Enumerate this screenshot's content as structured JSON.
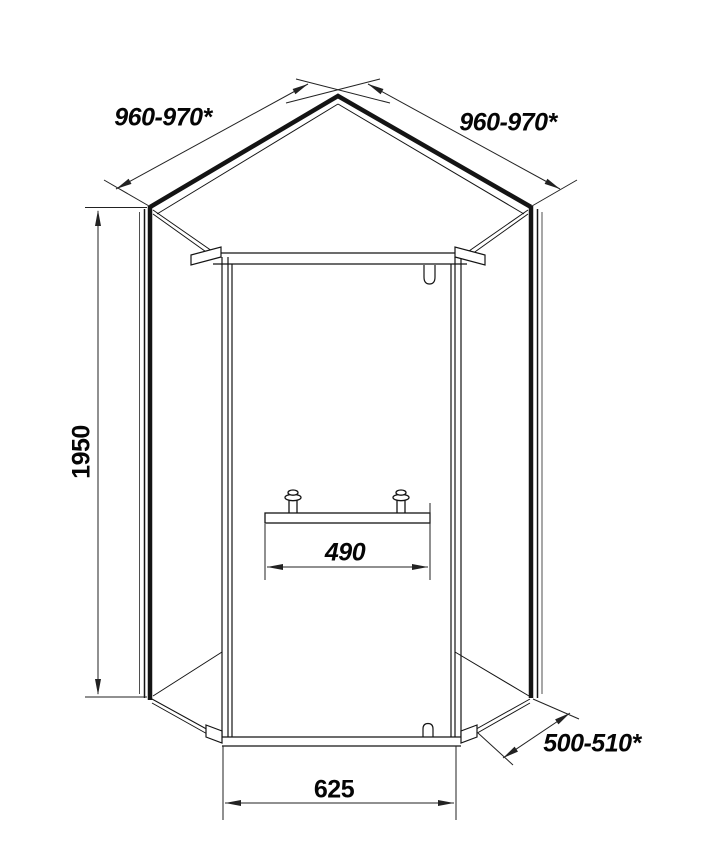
{
  "drawing": {
    "dim_top_left": "960-970*",
    "dim_top_right": "960-970*",
    "dim_height": "1950",
    "dim_handle": "490",
    "dim_front_width": "625",
    "dim_side_depth": "500-510*"
  }
}
